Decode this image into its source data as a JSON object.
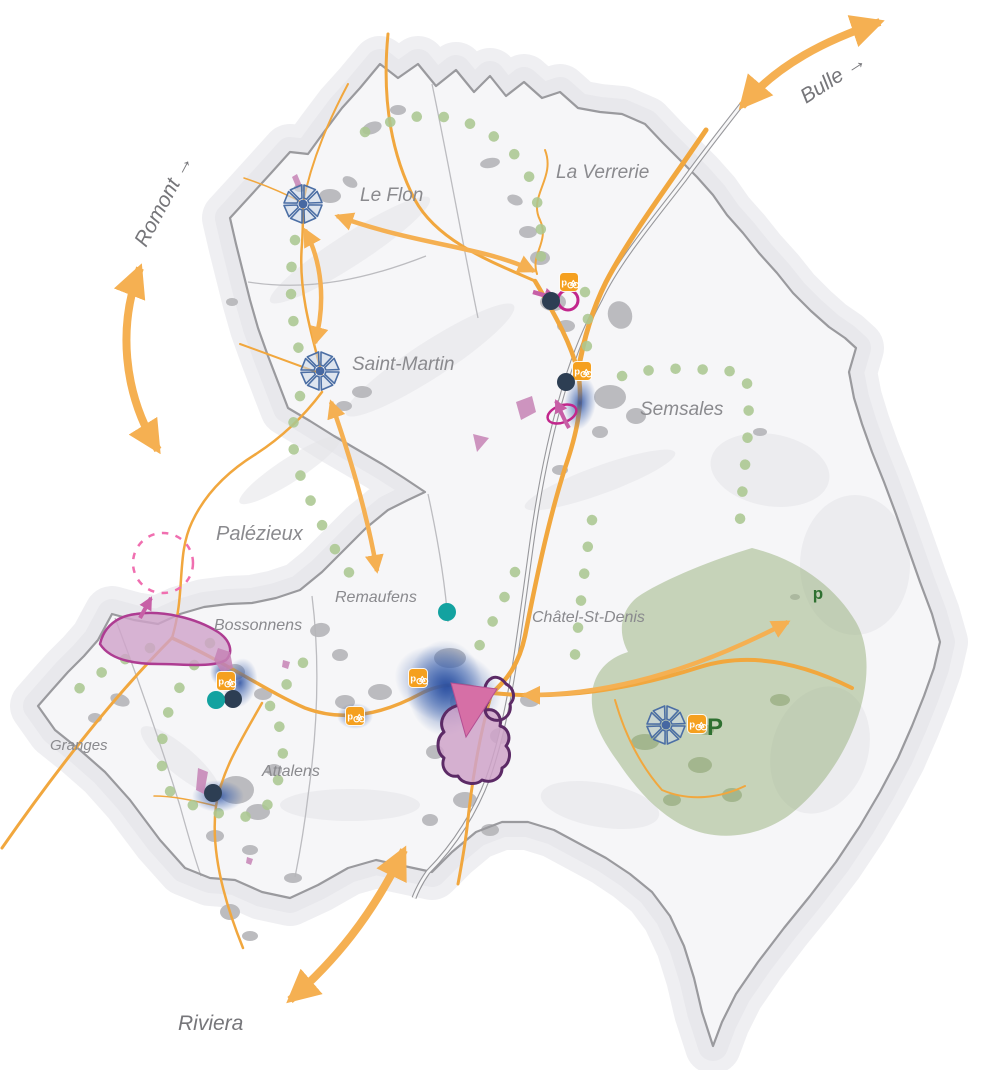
{
  "canvas": {
    "width": 988,
    "height": 1070
  },
  "palette": {
    "road_orange": "#F1A73E",
    "arrow_orange": "#F5B052",
    "map_label_gray": "#8A8A8E",
    "external_label_gray": "#76767A",
    "boundary_gray": "#9A9A9E",
    "railway_gray": "#97979B",
    "urban_gray": "#B5B5B8",
    "trail_dot_green": "#ABC791",
    "leisure_zone_green": "#9FB685",
    "parking_green": "#2F7031",
    "development_blue": "#2B4FA0",
    "hub_blue": "#4C6FA5",
    "magenta": "#C2268C",
    "pink_arrow": "#C75FA6",
    "pink_zone_fill": "#CFA3C9",
    "dark_purple_outline": "#5C2A66",
    "teal_dot": "#13A2A0",
    "dark_dot": "#2D3E53"
  },
  "external_connections": [
    {
      "name": "bulle",
      "label": "Bulle →",
      "x": 806,
      "y": 104,
      "rotation": -33,
      "font_size": 21
    },
    {
      "name": "romont",
      "label": "Romont →",
      "x": 146,
      "y": 248,
      "rotation": -62,
      "font_size": 21
    },
    {
      "name": "riviera",
      "label": "Riviera",
      "x": 178,
      "y": 1030,
      "rotation": 0,
      "font_size": 21
    }
  ],
  "places": [
    {
      "name": "Le Flon",
      "x": 360,
      "y": 201,
      "font_size": 19
    },
    {
      "name": "La Verrerie",
      "x": 556,
      "y": 178,
      "font_size": 19
    },
    {
      "name": "Saint-Martin",
      "x": 352,
      "y": 370,
      "font_size": 19
    },
    {
      "name": "Semsales",
      "x": 640,
      "y": 415,
      "font_size": 19
    },
    {
      "name": "Châtel-St-Denis",
      "x": 532,
      "y": 622,
      "font_size": 16
    },
    {
      "name": "Palézieux",
      "x": 216,
      "y": 540,
      "font_size": 20
    },
    {
      "name": "Bossonnens",
      "x": 214,
      "y": 630,
      "font_size": 16
    },
    {
      "name": "Remaufens",
      "x": 335,
      "y": 602,
      "font_size": 16
    },
    {
      "name": "Attalens",
      "x": 262,
      "y": 776,
      "font_size": 16
    },
    {
      "name": "Granges",
      "x": 50,
      "y": 750,
      "font_size": 15
    }
  ],
  "mobility_hubs": [
    {
      "place": "Le Flon",
      "x": 303,
      "y": 204
    },
    {
      "place": "Saint-Martin",
      "x": 320,
      "y": 371
    },
    {
      "place": "Les Paccots",
      "x": 666,
      "y": 725
    }
  ],
  "bike_stations": [
    {
      "x": 569,
      "y": 282
    },
    {
      "x": 582,
      "y": 371
    },
    {
      "x": 226,
      "y": 681
    },
    {
      "x": 355,
      "y": 716
    },
    {
      "x": 418,
      "y": 678
    },
    {
      "x": 697,
      "y": 724
    }
  ],
  "stops": {
    "dark": [
      {
        "x": 551,
        "y": 301
      },
      {
        "x": 566,
        "y": 382
      },
      {
        "x": 233,
        "y": 699
      },
      {
        "x": 213,
        "y": 793
      }
    ],
    "teal": [
      {
        "x": 216,
        "y": 700
      },
      {
        "x": 447,
        "y": 612
      }
    ]
  },
  "parking": [
    {
      "label": "P",
      "x": 715,
      "y": 735,
      "font_size": 24
    },
    {
      "label": "p",
      "x": 818,
      "y": 599,
      "font_size": 17
    }
  ],
  "markers": {
    "station_ring": {
      "x": 568,
      "y": 300,
      "r": 10
    },
    "semsales_loop": {
      "x": 562,
      "y": 414
    },
    "palezieux_dashed_circle": {
      "x": 163,
      "y": 563,
      "r": 30
    }
  }
}
